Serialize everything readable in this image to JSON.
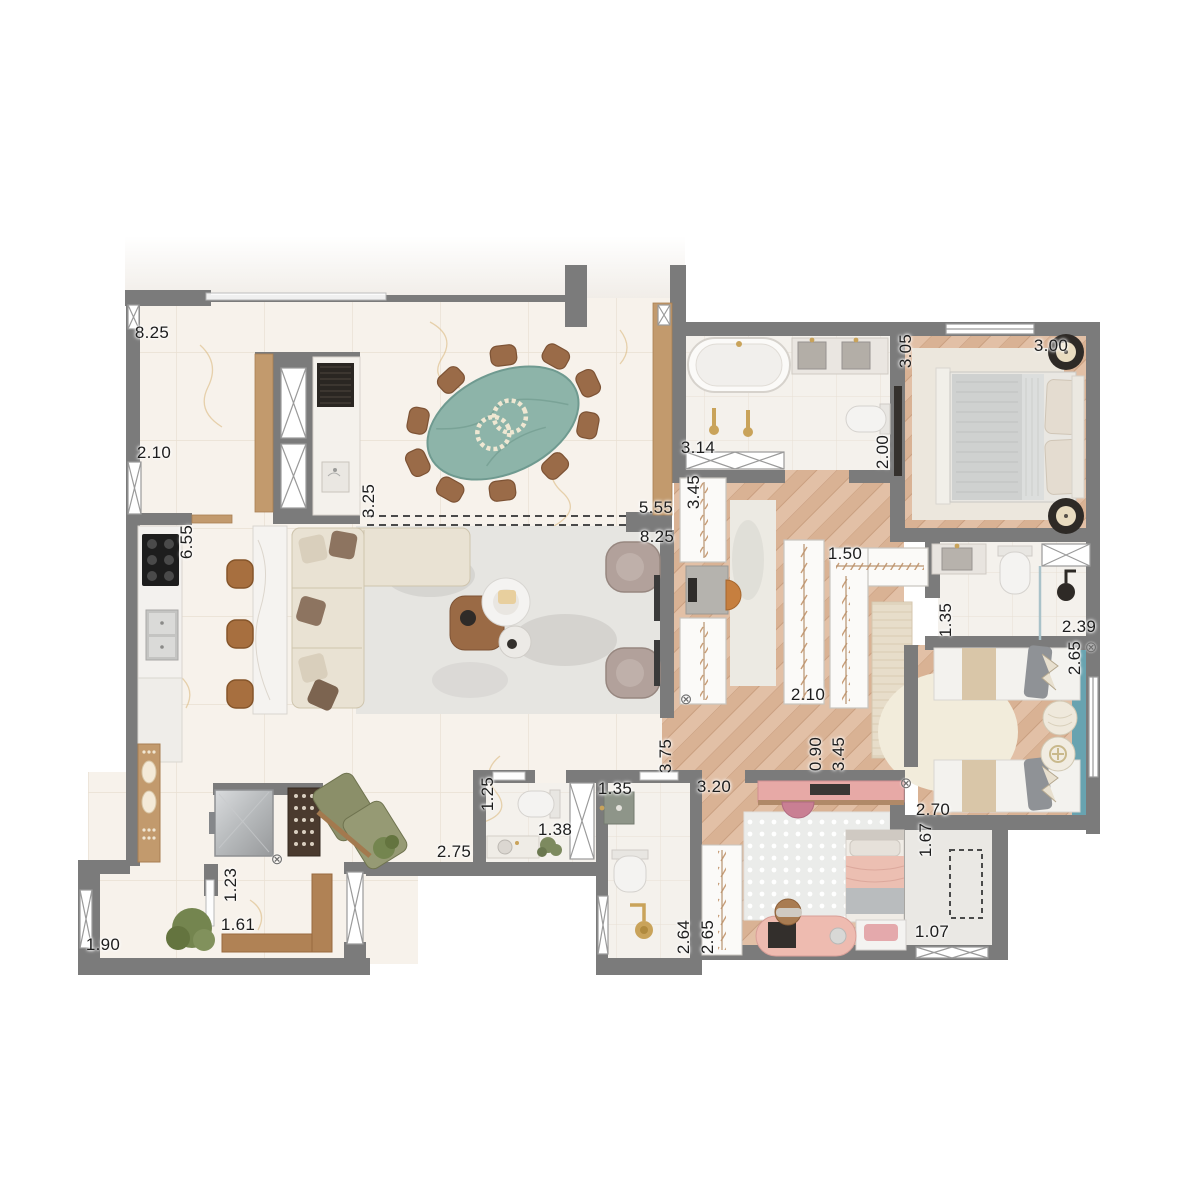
{
  "title": "apartment-floor-plan",
  "palette": {
    "wall": "#7b7b7b",
    "marble_floor": "#f7f2eb",
    "wood_floor": "#dfbda2",
    "bath_floor": "#f4f1ec",
    "teal_table": "#8db4a9",
    "teal_rug": "#68a3b0",
    "pink_furniture": "#e7a9a6",
    "olive_chair": "#8b8f69",
    "stool_wood": "#a76f3f",
    "label_text": "#1d1d1d"
  },
  "symbols": {
    "circle_x_glyph": "⊗"
  },
  "circle_x_markers": [
    {
      "x": 686,
      "y": 699
    },
    {
      "x": 906,
      "y": 783
    },
    {
      "x": 1091,
      "y": 647
    },
    {
      "x": 277,
      "y": 859
    }
  ],
  "dimension_labels": [
    {
      "text": "8.25",
      "x": 152,
      "y": 333,
      "rot": "h"
    },
    {
      "text": "2.10",
      "x": 154,
      "y": 453,
      "rot": "h"
    },
    {
      "text": "6.55",
      "x": 187,
      "y": 542,
      "rot": "v"
    },
    {
      "text": "3.25",
      "x": 369,
      "y": 501,
      "rot": "v"
    },
    {
      "text": "5.55",
      "x": 656,
      "y": 508,
      "rot": "h"
    },
    {
      "text": "8.25",
      "x": 657,
      "y": 537,
      "rot": "h"
    },
    {
      "text": "3.14",
      "x": 698,
      "y": 448,
      "rot": "h"
    },
    {
      "text": "3.45",
      "x": 694,
      "y": 492,
      "rot": "v"
    },
    {
      "text": "2.00",
      "x": 883,
      "y": 452,
      "rot": "v"
    },
    {
      "text": "3.05",
      "x": 906,
      "y": 351,
      "rot": "v"
    },
    {
      "text": "3.00",
      "x": 1051,
      "y": 346,
      "rot": "h"
    },
    {
      "text": "1.50",
      "x": 845,
      "y": 554,
      "rot": "h"
    },
    {
      "text": "1.35",
      "x": 946,
      "y": 620,
      "rot": "v"
    },
    {
      "text": "2.39",
      "x": 1079,
      "y": 627,
      "rot": "h"
    },
    {
      "text": "2.65",
      "x": 1075,
      "y": 658,
      "rot": "v"
    },
    {
      "text": "2.10",
      "x": 808,
      "y": 695,
      "rot": "h"
    },
    {
      "text": "0.90",
      "x": 816,
      "y": 754,
      "rot": "v"
    },
    {
      "text": "3.45",
      "x": 839,
      "y": 754,
      "rot": "v"
    },
    {
      "text": "3.75",
      "x": 666,
      "y": 756,
      "rot": "v"
    },
    {
      "text": "3.20",
      "x": 714,
      "y": 787,
      "rot": "h"
    },
    {
      "text": "2.70",
      "x": 933,
      "y": 810,
      "rot": "h"
    },
    {
      "text": "1.67",
      "x": 926,
      "y": 840,
      "rot": "v"
    },
    {
      "text": "1.07",
      "x": 932,
      "y": 932,
      "rot": "h"
    },
    {
      "text": "1.25",
      "x": 488,
      "y": 794,
      "rot": "v"
    },
    {
      "text": "1.35",
      "x": 615,
      "y": 789,
      "rot": "h"
    },
    {
      "text": "1.38",
      "x": 555,
      "y": 830,
      "rot": "h"
    },
    {
      "text": "2.75",
      "x": 454,
      "y": 852,
      "rot": "h"
    },
    {
      "text": "1.23",
      "x": 231,
      "y": 885,
      "rot": "v"
    },
    {
      "text": "1.61",
      "x": 238,
      "y": 925,
      "rot": "h"
    },
    {
      "text": "1.90",
      "x": 103,
      "y": 945,
      "rot": "h"
    },
    {
      "text": "2.64",
      "x": 684,
      "y": 937,
      "rot": "v"
    },
    {
      "text": "2.65",
      "x": 708,
      "y": 937,
      "rot": "v"
    }
  ]
}
